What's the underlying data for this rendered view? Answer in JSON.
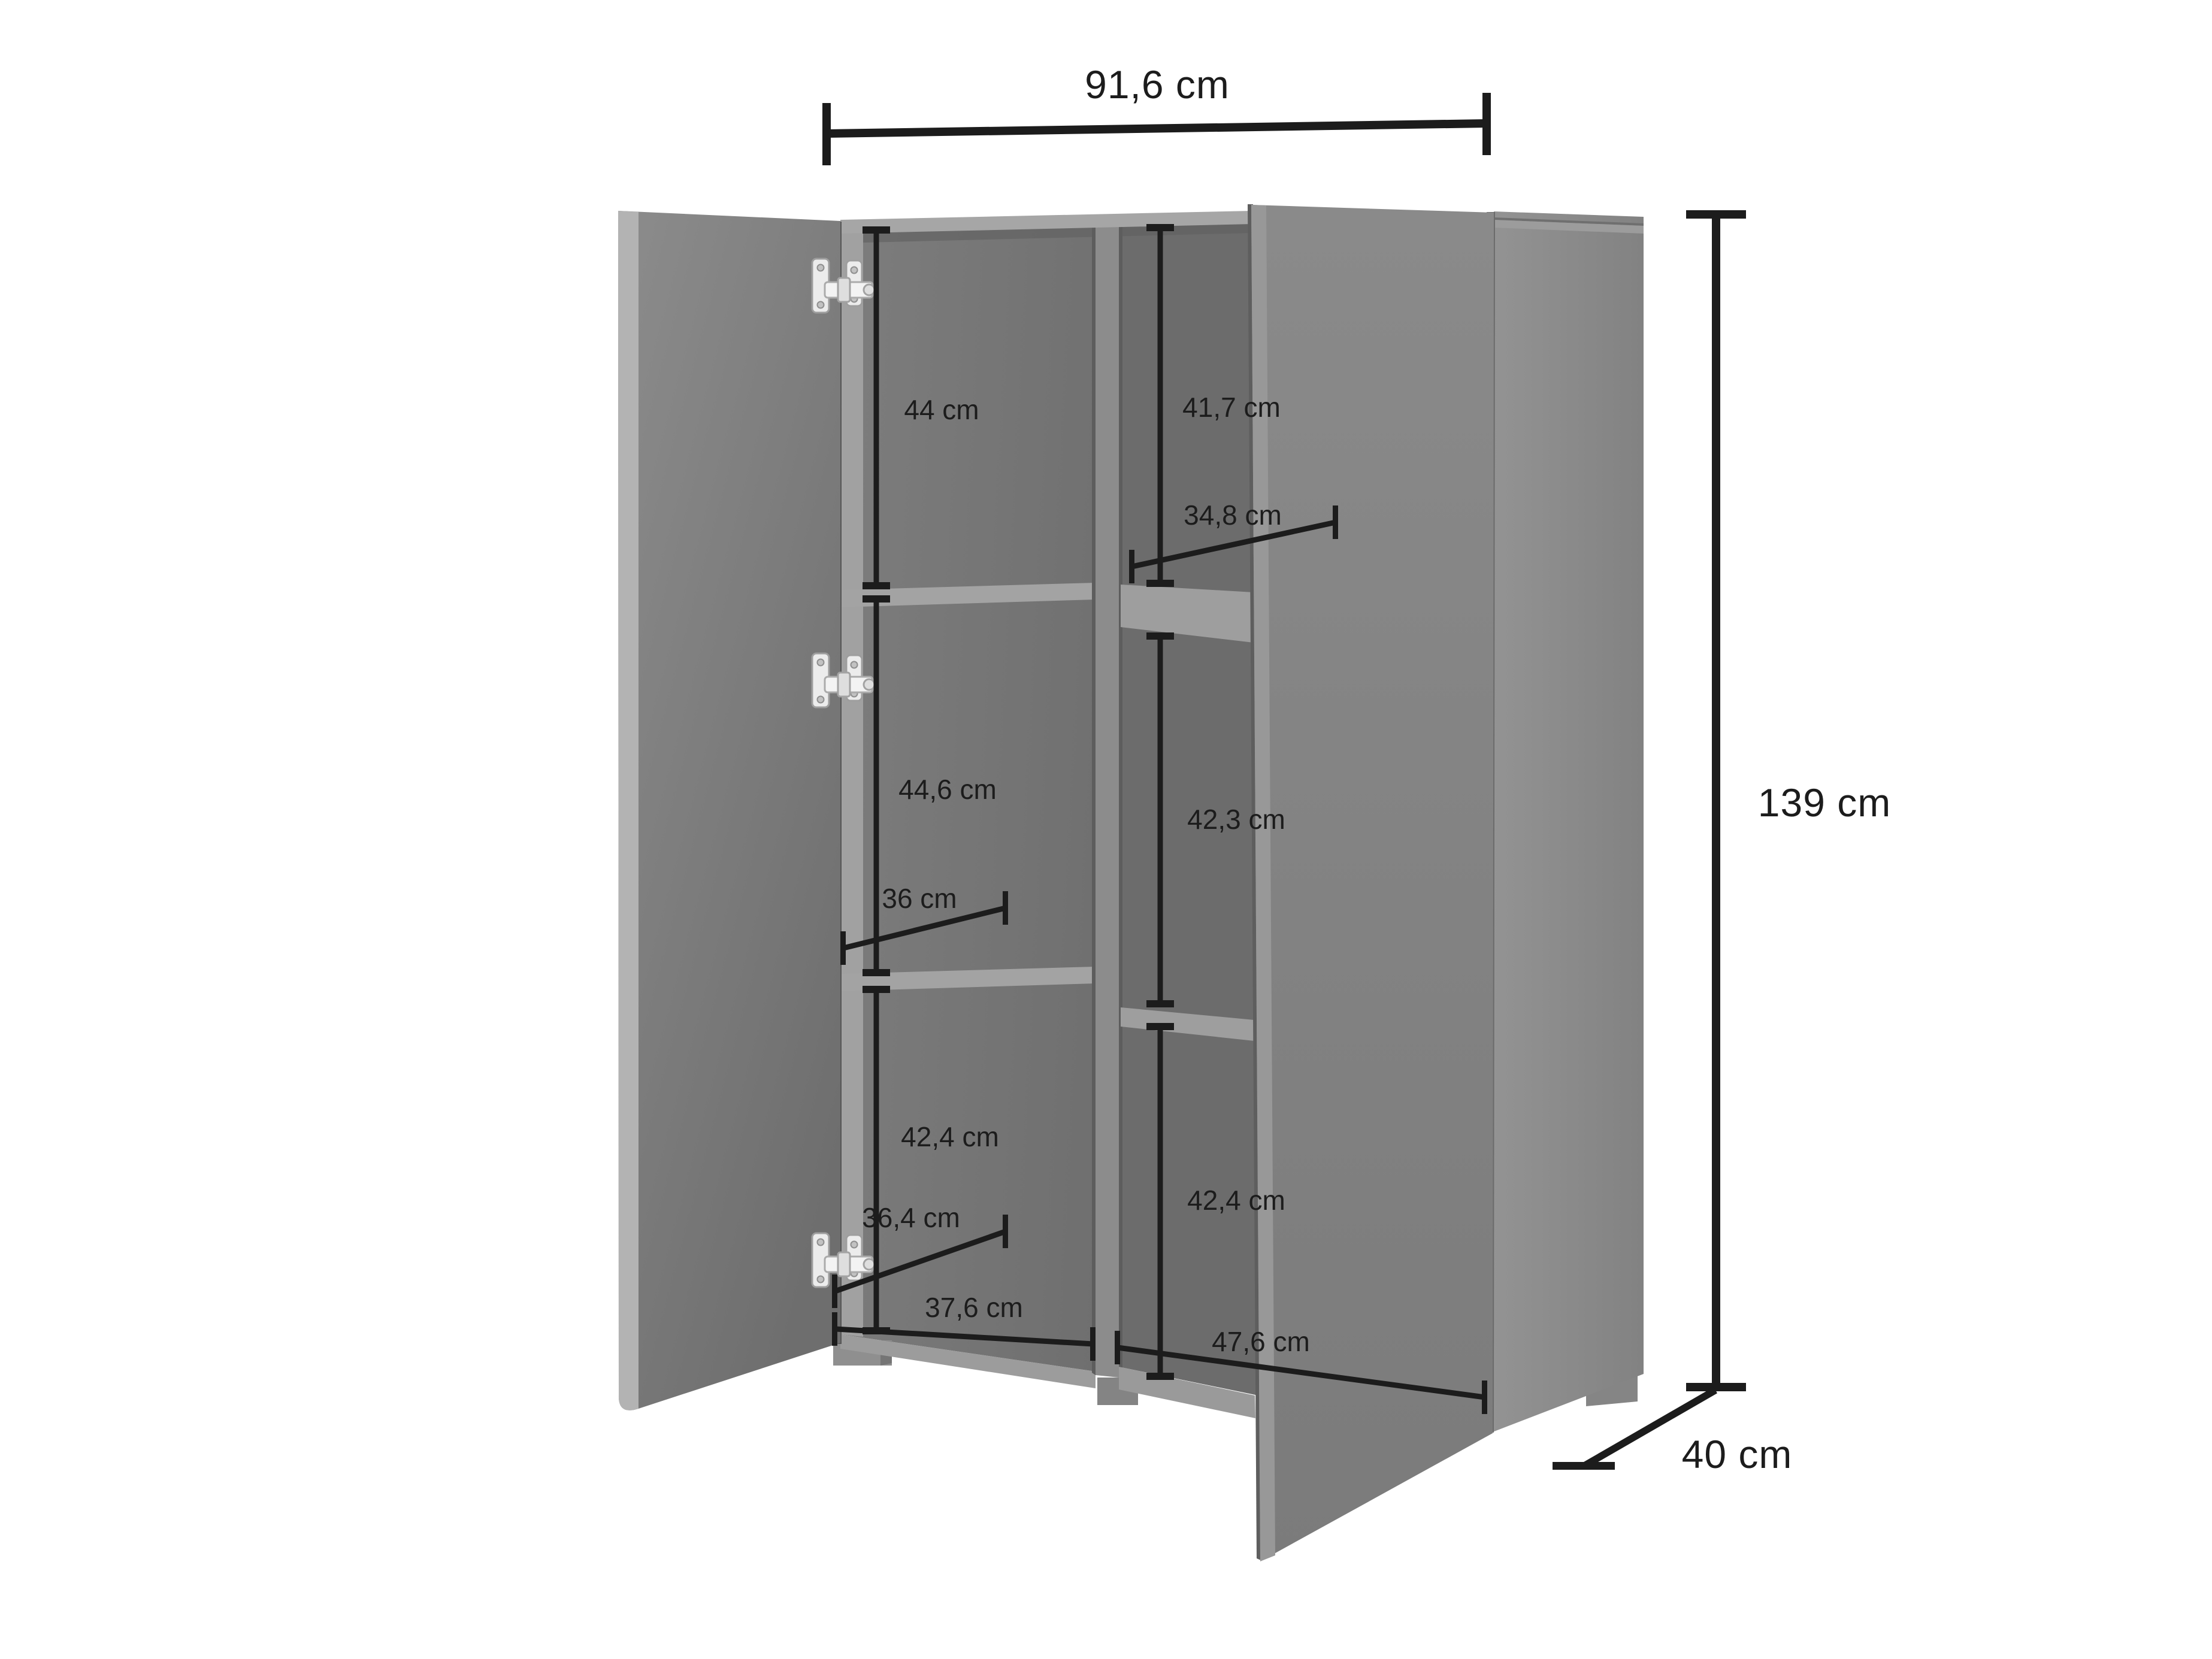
{
  "labels": {
    "outer_width": "91,6 cm",
    "outer_height": "139 cm",
    "outer_depth": "40 cm",
    "left_top_height": "44 cm",
    "left_middle_height": "44,6 cm",
    "left_bottom_height": "42,4 cm",
    "left_middle_depth": "36 cm",
    "left_bottom_depth": "36,4 cm",
    "left_inner_width": "37,6 cm",
    "right_top_height": "41,7 cm",
    "right_middle_height": "42,3 cm",
    "right_bottom_height": "42,4 cm",
    "right_top_depth": "34,8 cm",
    "right_inner_width": "47,6 cm"
  },
  "palette": {
    "background": "#ffffff",
    "dimension_line": "#1c1c1c",
    "interior_back": "#747474",
    "interior_back_dark": "#6c6c6c",
    "interior_top_shadow": "#616161",
    "inner_side_strip": "#a1a1a1",
    "shelf": "#a3a3a3",
    "shelf_right": "#9e9e9e",
    "floor": "#9c9c9c",
    "floor_right": "#9a9a9a",
    "divider": "#8c8c8c",
    "divider_seam": "#5d5d5d",
    "top_lip": "#a6a6a6",
    "left_door_edge": "#b3b3b3",
    "left_door_seam": "#565656",
    "right_door_edge": "#989898",
    "right_door_seam": "#5e5e5e",
    "panel_lip": "#9c9c9c",
    "panel_lip_line": "#6f6f6f",
    "panel_seam": "#6b6b6b",
    "foot": "#8f8f8f",
    "foot_side": "#757575",
    "foot_center": "#848484",
    "foot_back": "#858585",
    "hinge_metal": "#ececec"
  }
}
